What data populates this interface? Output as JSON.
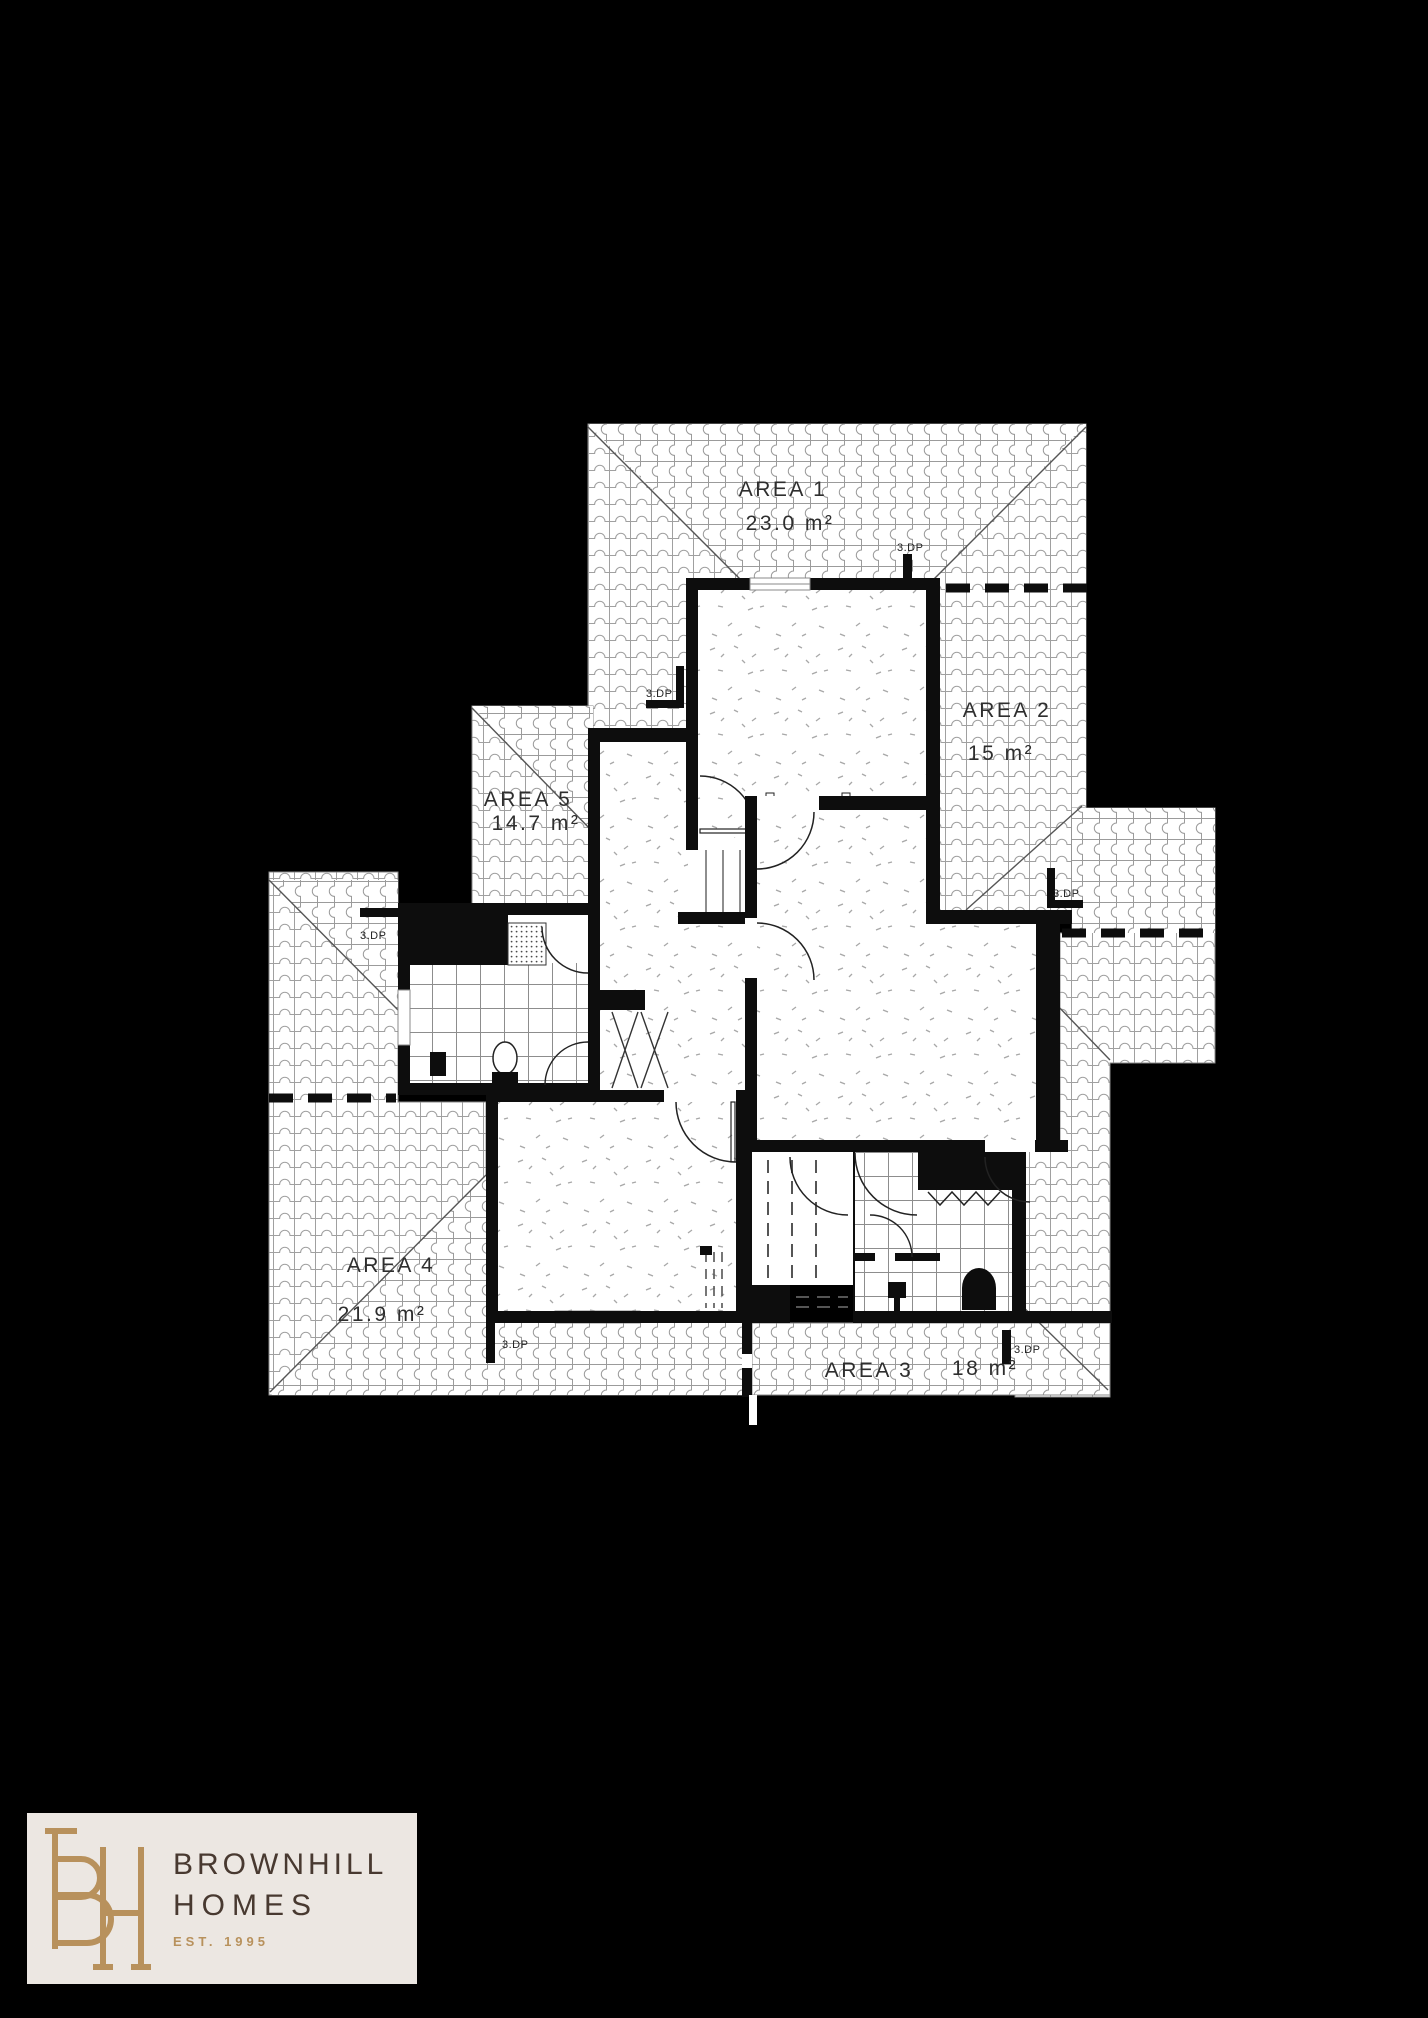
{
  "background": "#000000",
  "plan": {
    "areas": [
      {
        "name": "AREA 1",
        "size": "23.0 m²"
      },
      {
        "name": "AREA 2",
        "size": "15 m²"
      },
      {
        "name": "AREA 3",
        "size": "18 m²"
      },
      {
        "name": "AREA 4",
        "size": "21.9 m²"
      },
      {
        "name": "AREA 5",
        "size": "14.7 m²"
      }
    ],
    "downpipes": [
      {
        "label": "3.DP"
      },
      {
        "label": "3.DP"
      },
      {
        "label": "3.DP"
      },
      {
        "label": "3.DP"
      },
      {
        "label": "3.DP"
      },
      {
        "label": "3.DP"
      }
    ]
  },
  "logo": {
    "monogram": "BH",
    "brand_line1": "BROWNHILL",
    "brand_line2": "HOMES",
    "established": "EST. 1995",
    "colors": {
      "panel": "#ECE7E2",
      "gold": "#B8915C",
      "brown": "#483930"
    }
  }
}
